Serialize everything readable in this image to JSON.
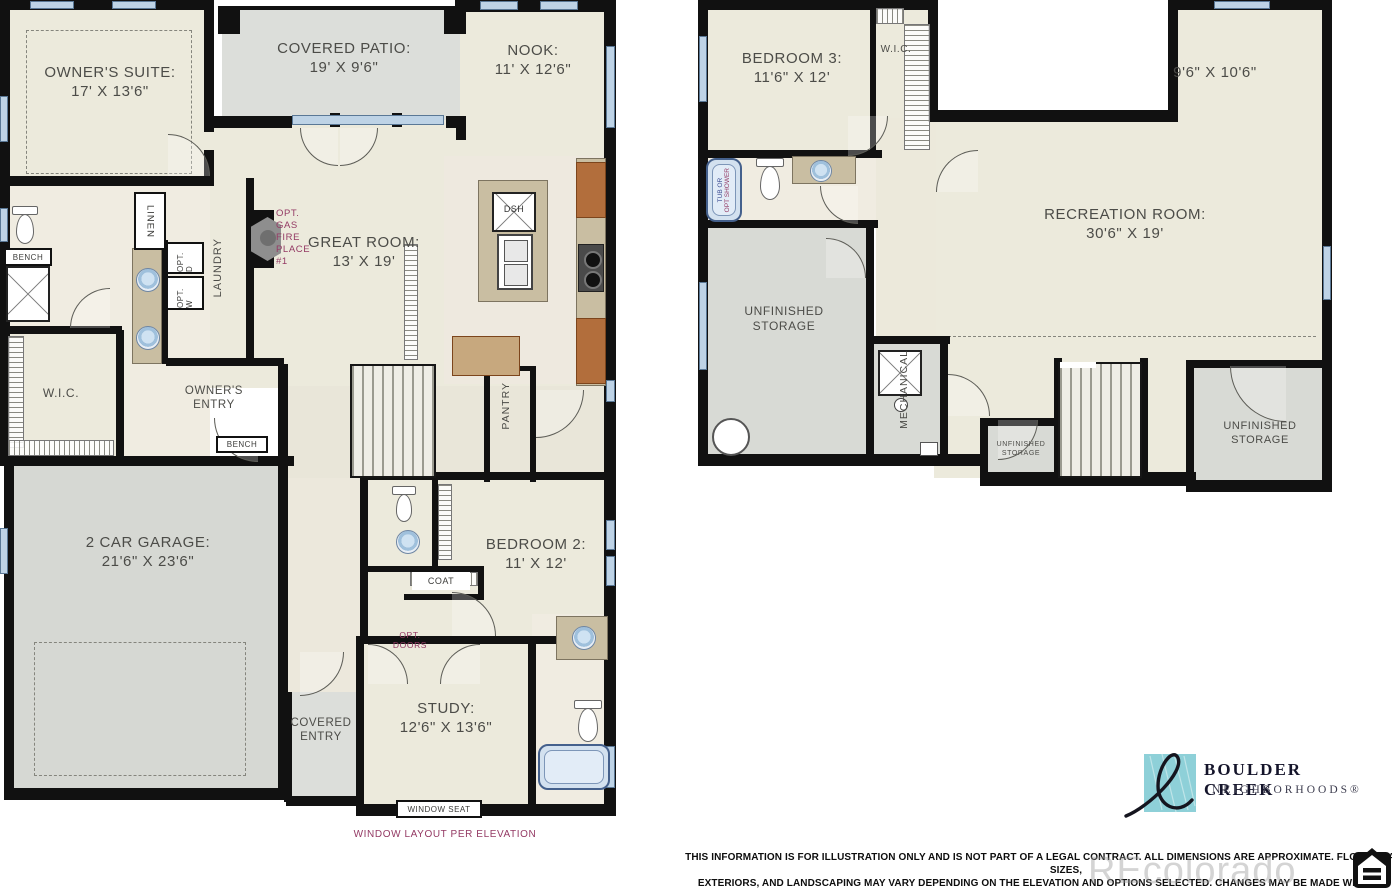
{
  "first_floor": {
    "owners_suite": {
      "name": "OWNER'S SUITE:",
      "dims": "17' X 13'6\""
    },
    "covered_patio": {
      "name": "COVERED PATIO:",
      "dims": "19' X 9'6\""
    },
    "nook": {
      "name": "NOOK:",
      "dims": "11' X 12'6\""
    },
    "great_room": {
      "name": "GREAT ROOM:",
      "dims": "13' X 19'"
    },
    "garage": {
      "name": "2 CAR GARAGE:",
      "dims": "21'6\" X 23'6\""
    },
    "bedroom2": {
      "name": "BEDROOM 2:",
      "dims": "11' X 12'"
    },
    "study": {
      "name": "STUDY:",
      "dims": "12'6\" X 13'6\""
    },
    "covered_entry": {
      "line1": "COVERED",
      "line2": "ENTRY"
    },
    "owners_entry": {
      "line1": "OWNER'S",
      "line2": "ENTRY"
    },
    "wic": "W.I.C.",
    "linen": "LINEN",
    "laundry": "LAUNDRY",
    "pantry": "PANTRY",
    "coat": "COAT",
    "bench_bath": "BENCH",
    "bench_entry": "BENCH",
    "window_seat": "WINDOW SEAT",
    "dishwasher": "DSH",
    "opt_washer": "OPT. W",
    "opt_dryer": "OPT. D",
    "fireplace_note": [
      "OPT.",
      "GAS",
      "FIRE",
      "PLACE",
      "#1"
    ],
    "opt_doors_note": {
      "line1": "OPT.",
      "line2": "DOORS"
    },
    "window_layout_note": "WINDOW LAYOUT PER ELEVATION"
  },
  "basement": {
    "bedroom3": {
      "name": "BEDROOM 3:",
      "dims": "11'6\" X 12'"
    },
    "flex_dims": "9'6\" X 10'6\"",
    "rec_room": {
      "name": "RECREATION ROOM:",
      "dims": "30'6\" X 19'"
    },
    "storage_large": {
      "line1": "UNFINISHED",
      "line2": "STORAGE"
    },
    "storage_small": {
      "line1": "UNFINISHED",
      "line2": "STORAGE"
    },
    "storage_right": {
      "line1": "UNFINISHED",
      "line2": "STORAGE"
    },
    "mechanical": "MECHANICAL",
    "wic": "W.I.C.",
    "tub_note": {
      "line1": "TUB OR",
      "line2": "OPT SHOWER"
    }
  },
  "footer": {
    "disclaimer": [
      "THIS INFORMATION IS FOR ILLUSTRATION ONLY AND IS NOT PART OF A LEGAL CONTRACT.  ALL DIMENSIONS ARE APPROXIMATE.  FLOOR PLANS, ROOM SIZES,",
      "EXTERIORS, AND LANDSCAPING MAY VARY DEPENDING ON THE ELEVATION  AND OPTIONS SELECTED. CHANGES MAY BE MADE WITHOUT NOTICE. WALKOUT",
      "LOWER LEVELS AND EXTENDED DECKS ARE HOMESITE DEPENDENT.  PLEASE CONTACT BOULDER CREEK NEIGHBORHOODS® FOR MORE DETAILS. ©WAR2023"
    ],
    "logo_line1": "BOULDER CREEK",
    "logo_line2": "NEIGHBORHOODS®",
    "watermark": "REcolorado"
  },
  "colors": {
    "wall": "#111111",
    "floor_beige": "#eceadc",
    "concrete_gray": "#dbddd8",
    "window_blue": "#bed3e6",
    "counter_tan": "#c9bea2",
    "cabinet_wood": "#b26e3c",
    "annotation_magenta": "#943a64",
    "logo_teal": "#8ed0d8"
  }
}
